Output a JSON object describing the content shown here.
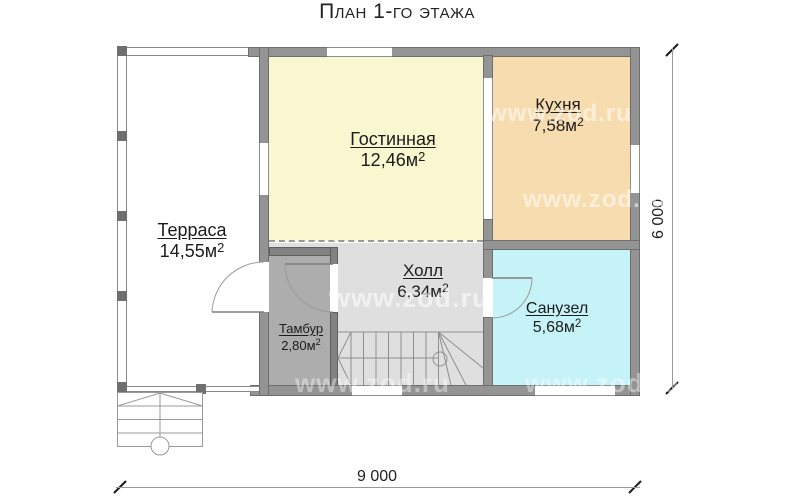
{
  "title": "План 1-го этажа",
  "rooms": {
    "terrace": {
      "name": "Терраса",
      "area": "14,55м",
      "area_sup": "2"
    },
    "living": {
      "name": "Гостинная",
      "area": "12,46м",
      "area_sup": "2"
    },
    "kitchen": {
      "name": "Кухня",
      "area": "7,58м",
      "area_sup": "2"
    },
    "hall": {
      "name": "Холл",
      "area": "6,34м",
      "area_sup": "2"
    },
    "vestibule": {
      "name": "Тамбур",
      "area": "2,80м",
      "area_sup": "2"
    },
    "bathroom": {
      "name": "Санузел",
      "area": "5,68м",
      "area_sup": "2"
    }
  },
  "dimensions": {
    "width": "9 000",
    "height": "6 000"
  },
  "watermark": "www.zod.ru",
  "colors": {
    "wall": "#949494",
    "wall_dark": "#828282",
    "living": "#f9f7cf",
    "kitchen": "#f6dcae",
    "bathroom": "#c6f3f7",
    "hall": "#dfdfdf",
    "vestibule": "#adadad"
  }
}
